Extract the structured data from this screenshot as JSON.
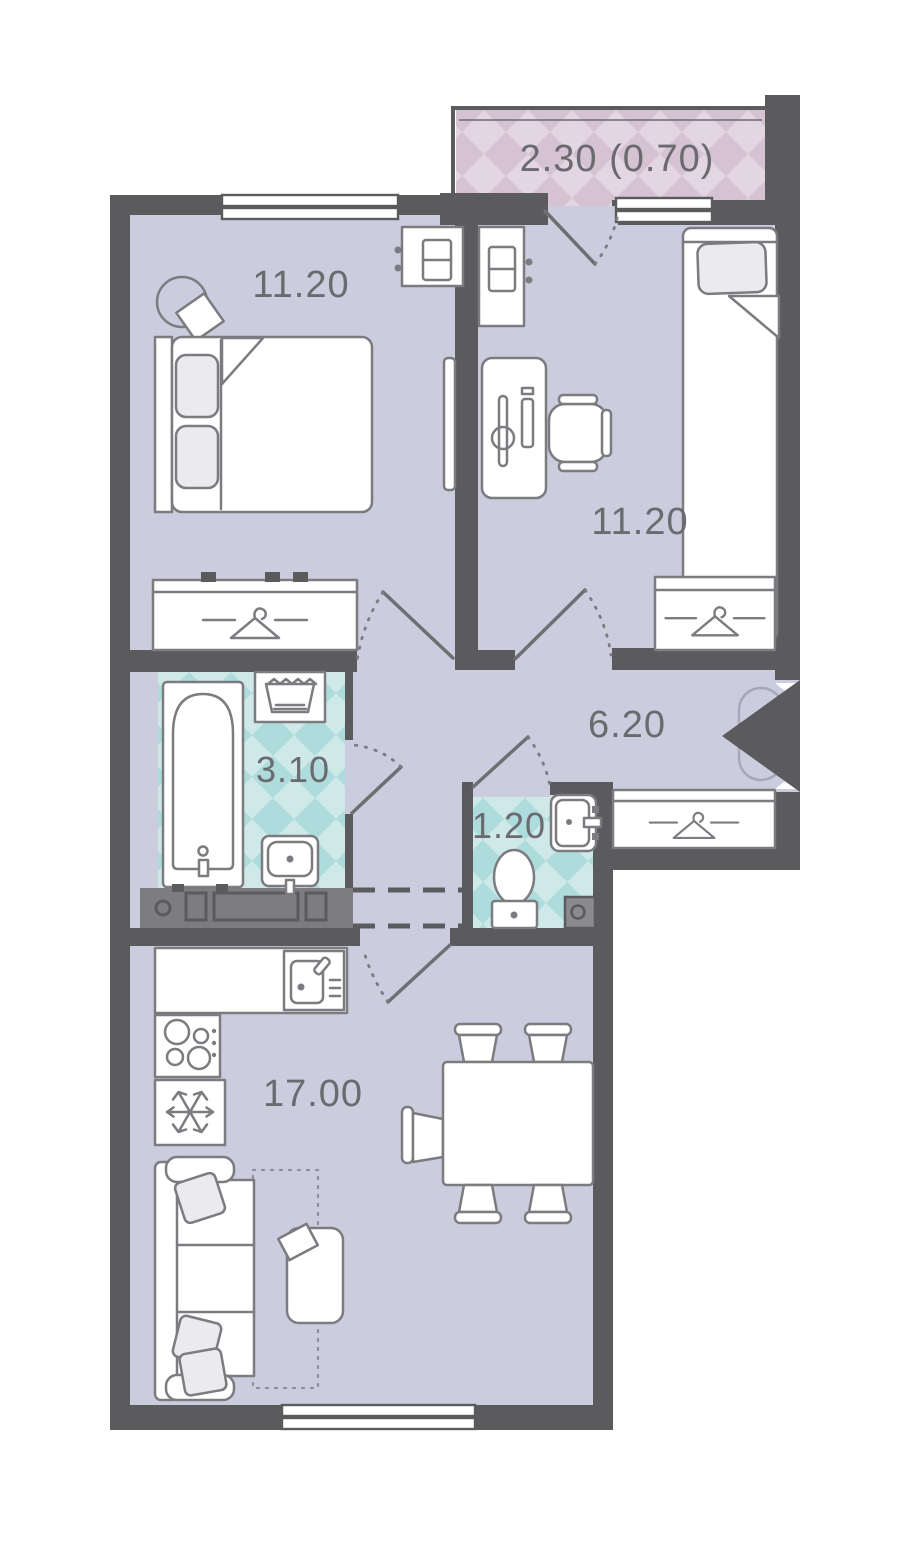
{
  "plan": {
    "type": "apartment-floor-plan",
    "rooms": [
      {
        "name": "balcony",
        "area_label": "2.30 (0.70)"
      },
      {
        "name": "bedroom-1",
        "area_label": "11.20"
      },
      {
        "name": "bedroom-2",
        "area_label": "11.20"
      },
      {
        "name": "hallway",
        "area_label": "6.20"
      },
      {
        "name": "bathroom",
        "area_label": "3.10"
      },
      {
        "name": "wc",
        "area_label": "1.20"
      },
      {
        "name": "kitchen-living-room",
        "area_label": "17.00"
      }
    ],
    "colors": {
      "wall": "#5b5b5e",
      "floor": "#cbcdde",
      "bathroom_tile_light": "#cfe9e9",
      "bathroom_tile_dark": "#aedcdc",
      "balcony_tile_light": "#e4d6e1",
      "balcony_tile_dark": "#d5c2d2",
      "furniture_line": "#7b7b80",
      "label_text": "#6b6b6f",
      "background": "#ffffff"
    }
  }
}
